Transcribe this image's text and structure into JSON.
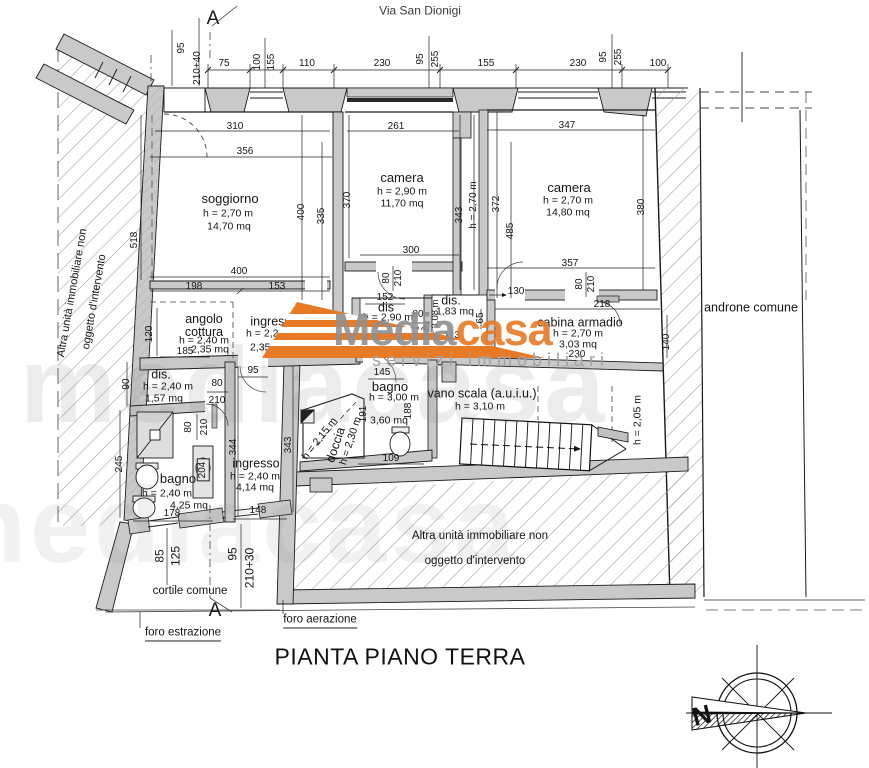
{
  "street": "Via San Dionigi",
  "title": "PIANTA PIANO TERRA",
  "section": {
    "top": "A",
    "bottom": "A"
  },
  "compass": {
    "n": "N"
  },
  "colors": {
    "accent": "#e87a25",
    "wall_gray": "#c9c9c9"
  },
  "watermark": {
    "media": "Media",
    "casa": "casa",
    "tagline": "servizi immobiliari",
    "big": "mediacasa"
  },
  "rooms": {
    "soggiorno": {
      "name": "soggiorno",
      "h": "h = 2,70 m",
      "area": "14,70 mq"
    },
    "camera1": {
      "name": "camera",
      "h": "h = 2,90 m",
      "area": "11,70 mq"
    },
    "camera2": {
      "name": "camera",
      "h": "h = 2,70 m",
      "area": "14,80 mq"
    },
    "angolo": {
      "name": "angolo cottura",
      "h": "h = 2,40 m",
      "area": "2,35 mq"
    },
    "ingresso1": {
      "name": "ingresso",
      "h": "h = 2,20 m",
      "area": "2,35 mq"
    },
    "dis1": {
      "name": "dis",
      "h": "h = 2,90 m",
      "area": "1,94 mq"
    },
    "dis2": {
      "name": "dis.",
      "area": "1,83 mq",
      "hv": "h = 3,08 m"
    },
    "cabina": {
      "name": "cabina armadio",
      "h": "h = 2,70 m",
      "area": "3,03 mq"
    },
    "bagno1": {
      "name": "bagno",
      "h": "h = 3,00 m",
      "area": "3,60 mq"
    },
    "doccia": {
      "name": "doccia",
      "h": "h = 2,30 m",
      "h2": "h = 2,15 m"
    },
    "scala": {
      "name": "vano scala (a.u.i.u.)",
      "h": "h = 3,10 m",
      "hv": "h = 2,05 m"
    },
    "dis3": {
      "name": "dis.",
      "h": "h = 2,40 m",
      "area": "1,57 mq"
    },
    "bagno2": {
      "name": "bagno",
      "h": "h = 2,40 m",
      "area": "4,25 mq"
    },
    "ingresso2": {
      "name": "ingresso",
      "h": "h = 2,40 m",
      "area": "4,14 mq"
    },
    "androne": {
      "name": "androne comune"
    },
    "cortile": {
      "name": "cortile comune"
    }
  },
  "other_unit": {
    "line1": "Altra unità immobiliare non",
    "line2": "oggetto d'intervento"
  },
  "notes": {
    "foro1": "foro estrazione",
    "foro2": "foro aerazione"
  },
  "dims": {
    "top": [
      "75",
      "100",
      "155",
      "110",
      "230",
      "95",
      "255",
      "155",
      "230",
      "95",
      "255",
      "100"
    ],
    "door_tl": [
      "95",
      "210+40"
    ],
    "d310": "310",
    "d356": "356",
    "d261": "261",
    "d347": "347",
    "d518": "518",
    "d400v": "400",
    "d335": "335",
    "d370": "370",
    "d343a": "343",
    "h270v": "h = 2,70 m",
    "d372": "372",
    "d485": "485",
    "d380": "380",
    "d400": "400",
    "d198": "198",
    "d153": "153",
    "d300": "300",
    "d357": "357",
    "d80a": "80",
    "d210a": "210",
    "d80b": "80",
    "d210b": "210",
    "d130": "130",
    "d218": "218",
    "d230": "230",
    "d140": "140",
    "d120": "120",
    "d185": "185",
    "d95a": "95",
    "d152": "152",
    "d80c": "80",
    "d210c": "210",
    "d113": "113",
    "d65": "65",
    "d145": "145",
    "d109": "109",
    "d191": "191",
    "d188": "188",
    "d90": "90",
    "d80d": "80",
    "d210d": "210",
    "d80e": "80",
    "d210e": "210",
    "d204": "204",
    "d245": "245",
    "d344": "344",
    "d343b": "343",
    "d178": "178",
    "d148": "148",
    "bottom": [
      "85",
      "125",
      "95",
      "210+30"
    ],
    "h205v": "h = 2,05 m"
  }
}
